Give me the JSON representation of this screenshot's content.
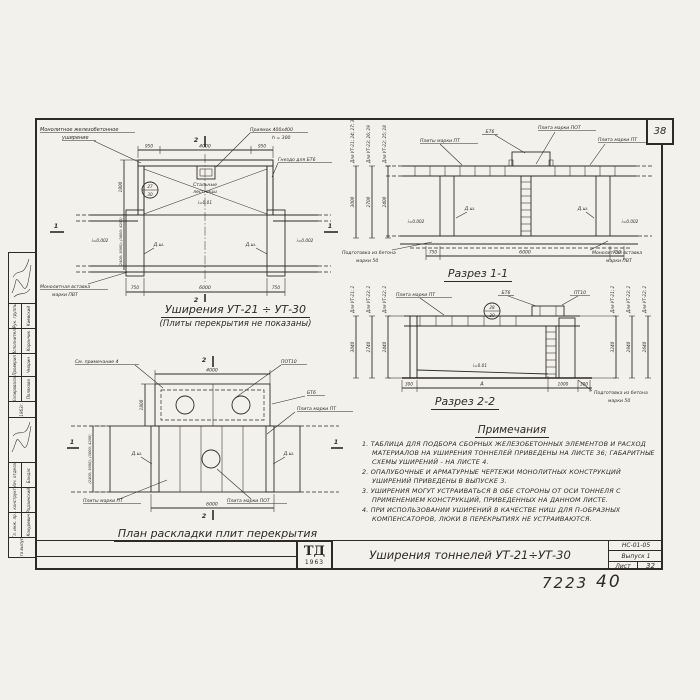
{
  "page": {
    "corner_number": "38",
    "footer_left": "7223",
    "footer_right": "40"
  },
  "title_block": {
    "logo_top": "ТД",
    "logo_year": "1963",
    "title": "Уширения тоннелей УТ-21÷УТ-30",
    "doc_number": "НС-01-05",
    "issue": "Выпуск 1",
    "sheet_label": "Лист",
    "sheet_number": "32"
  },
  "stamp": {
    "group1": [
      {
        "role": "Рук. группы",
        "name": "Киевский"
      },
      {
        "role": "Исполнитель",
        "name": "Корончик"
      },
      {
        "role": "Проверил",
        "name": "Чмарин"
      },
      {
        "role": "Копировала",
        "name": "Полякова"
      }
    ],
    "year": "1963г.",
    "group2": [
      {
        "role": "Нач. отдела",
        "name": "Бандас"
      },
      {
        "role": "Гл. конструктор",
        "name": "Радзинский"
      },
      {
        "role": "Гл. инж. пр.",
        "name": "Кокуревич"
      }
    ],
    "date_label": "Дата выпуска"
  },
  "plan_widening": {
    "title": "Уширения УТ-21 ÷ УТ-30",
    "subtitle": "(Плиты перекрытия не показаны)",
    "labels": {
      "mw1": "Монолитное железобетонное",
      "mw2": "уширение",
      "pit1": "Приямок 400x400",
      "pit2": "h = 300",
      "socket": "Гнездо для БТ6",
      "stairs1": "Стальные",
      "stairs2": "лестницы",
      "ins1": "Монолитная вставка",
      "ins2": "марки ПВТ",
      "joint": "Д.ш.",
      "slope_side": "i=0.002",
      "slope_center": "i=0.01",
      "ref_top": "27",
      "ref_bottom": "30"
    },
    "dims": {
      "t1": "950",
      "t2": "4000",
      "t3": "950",
      "b1": "750",
      "b2": "6000",
      "b3": "750",
      "depth": "1800",
      "width": "(2400; 3000); (3600; 4200)"
    },
    "marks": {
      "v": "2",
      "h": "1"
    }
  },
  "section_1_1": {
    "title": "Разрез 1-1",
    "rot": [
      {
        "label": "Для УТ-21; 24; 27; 30",
        "value": "3000"
      },
      {
        "label": "Для УТ-23; 26; 29",
        "value": "2700"
      },
      {
        "label": "Для УТ-22; 25; 28",
        "value": "2400"
      }
    ],
    "labels": {
      "bt6": "БТ6",
      "pot": "Плита марки ПОТ",
      "pts": "Плиты марки ПТ",
      "pt": "Плита марки ПТ",
      "prep1": "Подготовка из бетона",
      "prep2": "марки 50",
      "ins1": "Монолитная вставка",
      "ins2": "марки ПВТ",
      "joint": "Д.ш.",
      "slope": "i=0.002"
    },
    "dims": {
      "l": "750",
      "c": "6000",
      "r": "750"
    }
  },
  "section_2_2": {
    "title": "Разрез 2-2",
    "rotl": [
      {
        "label": "Для УТ-21; 24; 27; 30",
        "value": "3040"
      },
      {
        "label": "Для УТ-23; 26; 29",
        "value": "2740"
      },
      {
        "label": "Для УТ-22; 25; 28",
        "value": "2440"
      }
    ],
    "rotr": [
      {
        "label": "Для УТ-21; 24; 27; 30",
        "value": "3240"
      },
      {
        "label": "Для УТ-23; 26; 29",
        "value": "2940"
      },
      {
        "label": "Для УТ-22; 25; 28",
        "value": "2640"
      }
    ],
    "labels": {
      "pt": "Плита марки ПТ",
      "bt6": "БТ6",
      "pt10": "ПТ10",
      "slope": "i=0.01",
      "prep1": "Подготовка из бетона",
      "prep2": "марки 50",
      "ref_top": "28",
      "ref_bottom": "30"
    },
    "dims": {
      "d1": "300",
      "d2": "А",
      "d3": "1000",
      "d4": "300"
    }
  },
  "plan_slabs": {
    "title": "План раскладки плит перекрытия",
    "labels": {
      "note4": "См. примечание 4",
      "pot10": "ПОТ10",
      "bt6": "БТ6",
      "pt": "Плита марки ПТ",
      "pts": "Плиты марки ПТ",
      "pot": "Плита марки ПОТ",
      "joint": "Д.ш."
    },
    "dims": {
      "top": "4000",
      "bottom": "6000",
      "depth": "1800",
      "width": "(2400; 3000); (3600; 4200)"
    },
    "marks": {
      "v": "2",
      "h": "1"
    }
  },
  "notes": {
    "title": "Примечания",
    "items": [
      "1. Таблица для подбора сборных железобетонных элементов и расход материалов на уширения тоннелей приведены на листе 36; габаритные схемы уширений - на листе 4.",
      "2. Опалубочные и арматурные чертежи монолитных конструкций уширений приведены в выпуске 3.",
      "3. Уширения могут устраиваться в обе стороны от оси тоннеля с применением конструкций, приведенных на данном листе.",
      "4. При использовании уширений в качестве ниш для П-образных компенсаторов, люки в перекрытиях не устраиваются."
    ]
  }
}
